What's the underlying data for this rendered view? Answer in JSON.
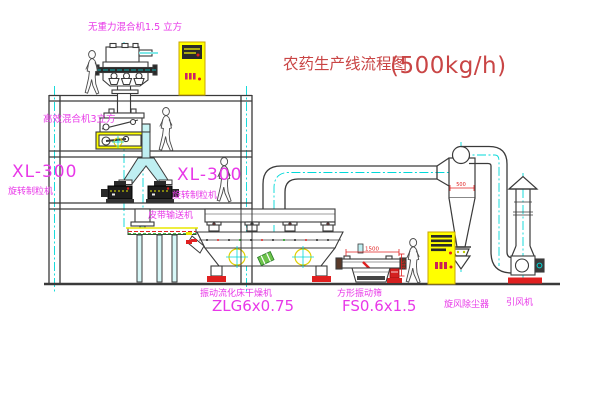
{
  "title": {
    "text": "农药生产线流程图",
    "capacity": "(500kg/h)"
  },
  "labels": {
    "gravity_mixer": "无重力混合机1.5 立方",
    "high_eff_mixer": "高效混合机3立方",
    "granulator_model_left": "XL-300",
    "granulator_name_left": "旋转制粒机",
    "granulator_model_right": "XL-300",
    "granulator_name_right": "旋转制粒机",
    "belt_conveyor": "皮带输送机",
    "dryer_name": "振动流化床干燥机",
    "dryer_model": "ZLG6x0.75",
    "screen_name": "方形振动筛",
    "screen_model": "FS0.6x1.5",
    "cyclone": "旋风除尘器",
    "fan": "引风机"
  },
  "dimensions": {
    "screen_length": "1500",
    "screen_height": "345",
    "cyclone_diameter": "500"
  },
  "colors": {
    "label_magenta": "#e838e8",
    "title_red": "#c94545",
    "dimension_red": "#e02020",
    "line_dark": "#3a3a3a",
    "accent_yellow": "#ffff00",
    "accent_cyan": "#00d8d8",
    "accent_green": "#12a012"
  }
}
